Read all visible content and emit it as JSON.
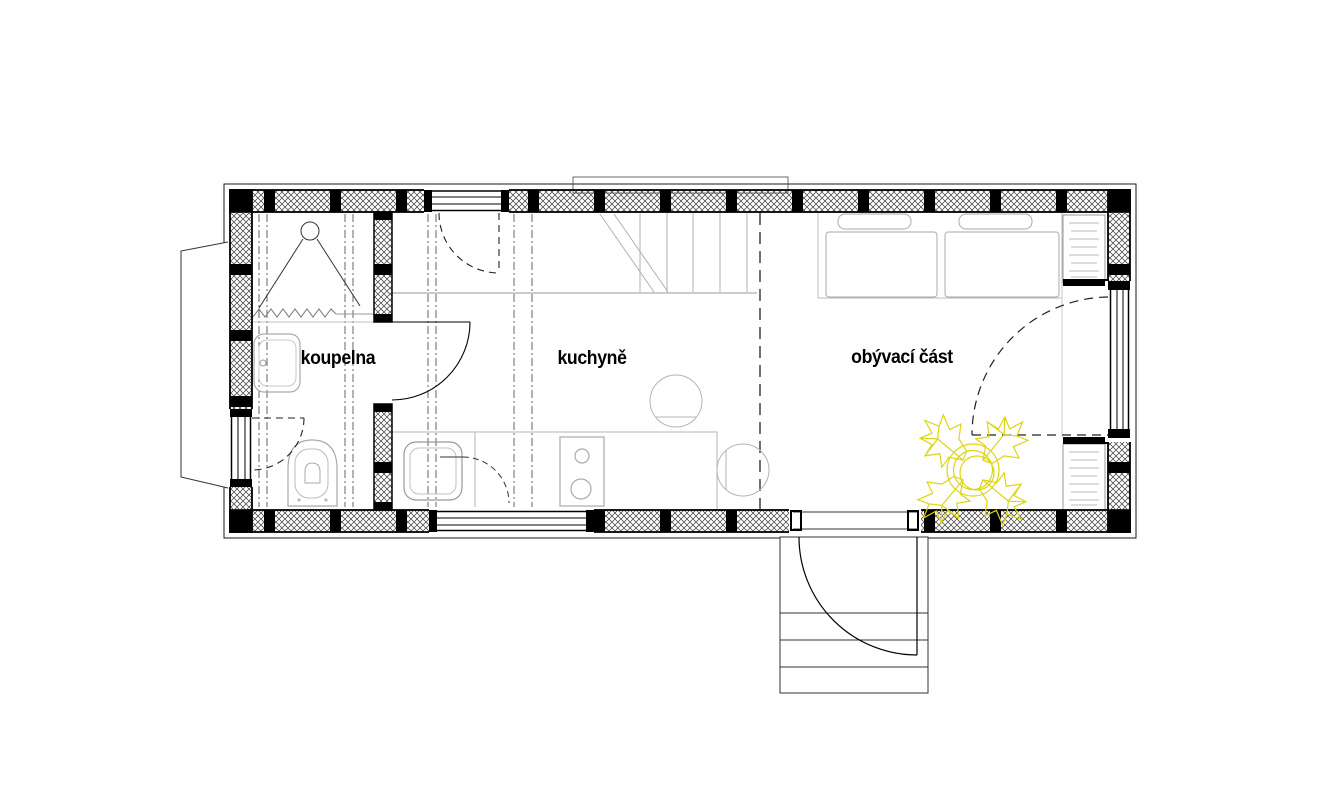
{
  "page": {
    "type": "architectural floor plan",
    "subject": "tiny house / mobile home layout",
    "background": "#ffffff"
  },
  "rooms": [
    {
      "label": "koupelna"
    },
    {
      "label": "kuchyně"
    },
    {
      "label": "obývací část"
    }
  ],
  "fixtures": {
    "bathroom": [
      "shower-head",
      "shower-curtain",
      "washbasin",
      "toilet",
      "window"
    ],
    "kitchen": [
      "loft-stairs",
      "kitchen-counter",
      "kitchen-sink",
      "stove-two-burners",
      "chairs",
      "window"
    ],
    "living-area": [
      "bed",
      "bed",
      "pillows",
      "shelf-unit-top",
      "shelf-unit-bottom",
      "potted-plant",
      "french-window"
    ],
    "exterior": [
      "trailer-drawbar",
      "entrance-door",
      "entrance-steps",
      "roof-outline",
      "skylight-outline"
    ]
  },
  "colors": {
    "linework": "#000000",
    "furniture_line": "#aaaaaa",
    "loft_line": "#999999",
    "plant": "#ded414",
    "background": "#ffffff"
  }
}
